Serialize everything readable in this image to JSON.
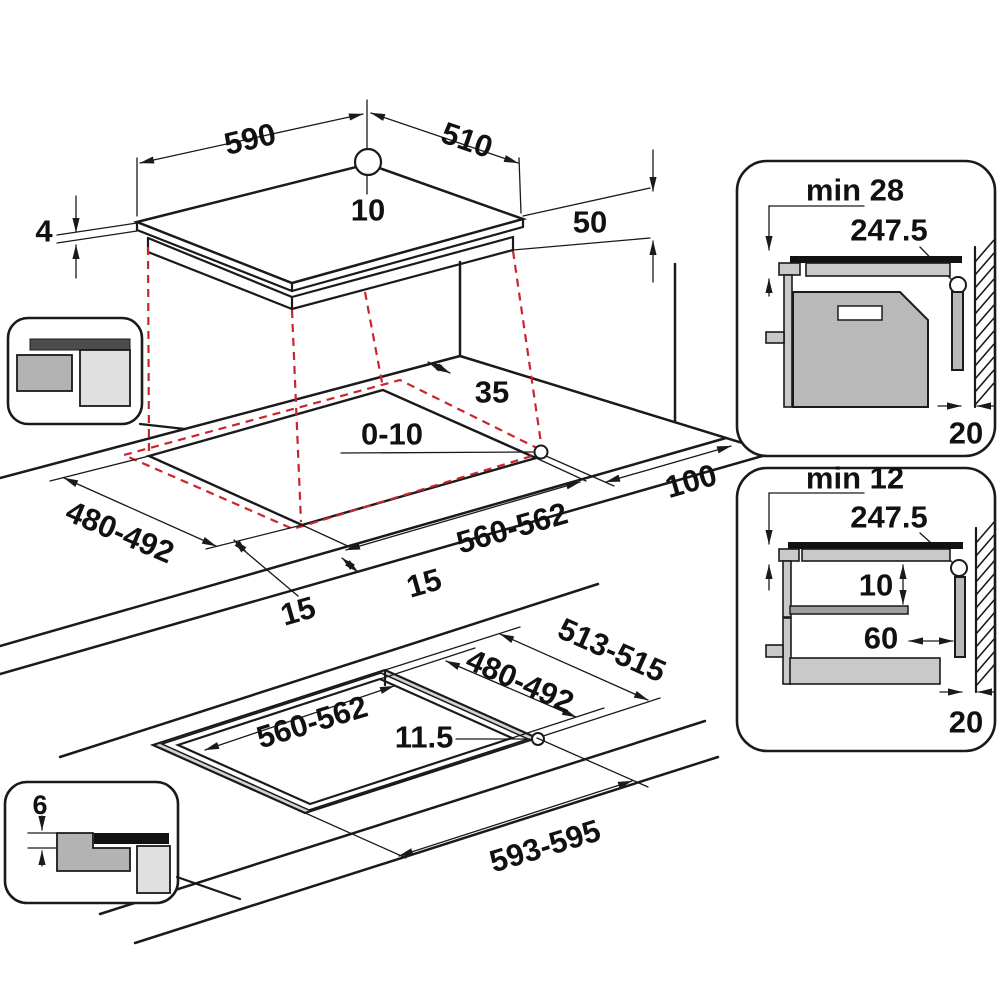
{
  "colors": {
    "line": "#1a1a1a",
    "accent_red_dashed": "#c9252c",
    "gray_light": "#c9c9c9",
    "gray_mid": "#b9b9b9",
    "gray_dark": "#9f9f9f",
    "background": "#ffffff"
  },
  "labels": {
    "hob": {
      "width": "590",
      "depth": "510",
      "center_mark": "10",
      "glass_thickness": "4",
      "body_height": "50"
    },
    "cutout": {
      "rear_gap": "35",
      "side_gap": "0-10",
      "right_clearance": "100",
      "depth": "480-492",
      "width": "560-562",
      "overhang_side": "15",
      "overhang_front": "15"
    },
    "flush": {
      "outer_depth": "513-515",
      "cut_depth": "480-492",
      "cut_width": "560-562",
      "ledge": "11.5",
      "outer_width": "593-595"
    },
    "section_oven": {
      "clearance": "min 28",
      "hole_offset": "247.5",
      "wall_gap": "20"
    },
    "section_shelf": {
      "clearance": "min 12",
      "hole_offset": "247.5",
      "shelf_gap": "10",
      "shelf_inset": "60",
      "wall_gap": "20"
    },
    "flush_icon": {
      "recess_depth": "6"
    }
  }
}
